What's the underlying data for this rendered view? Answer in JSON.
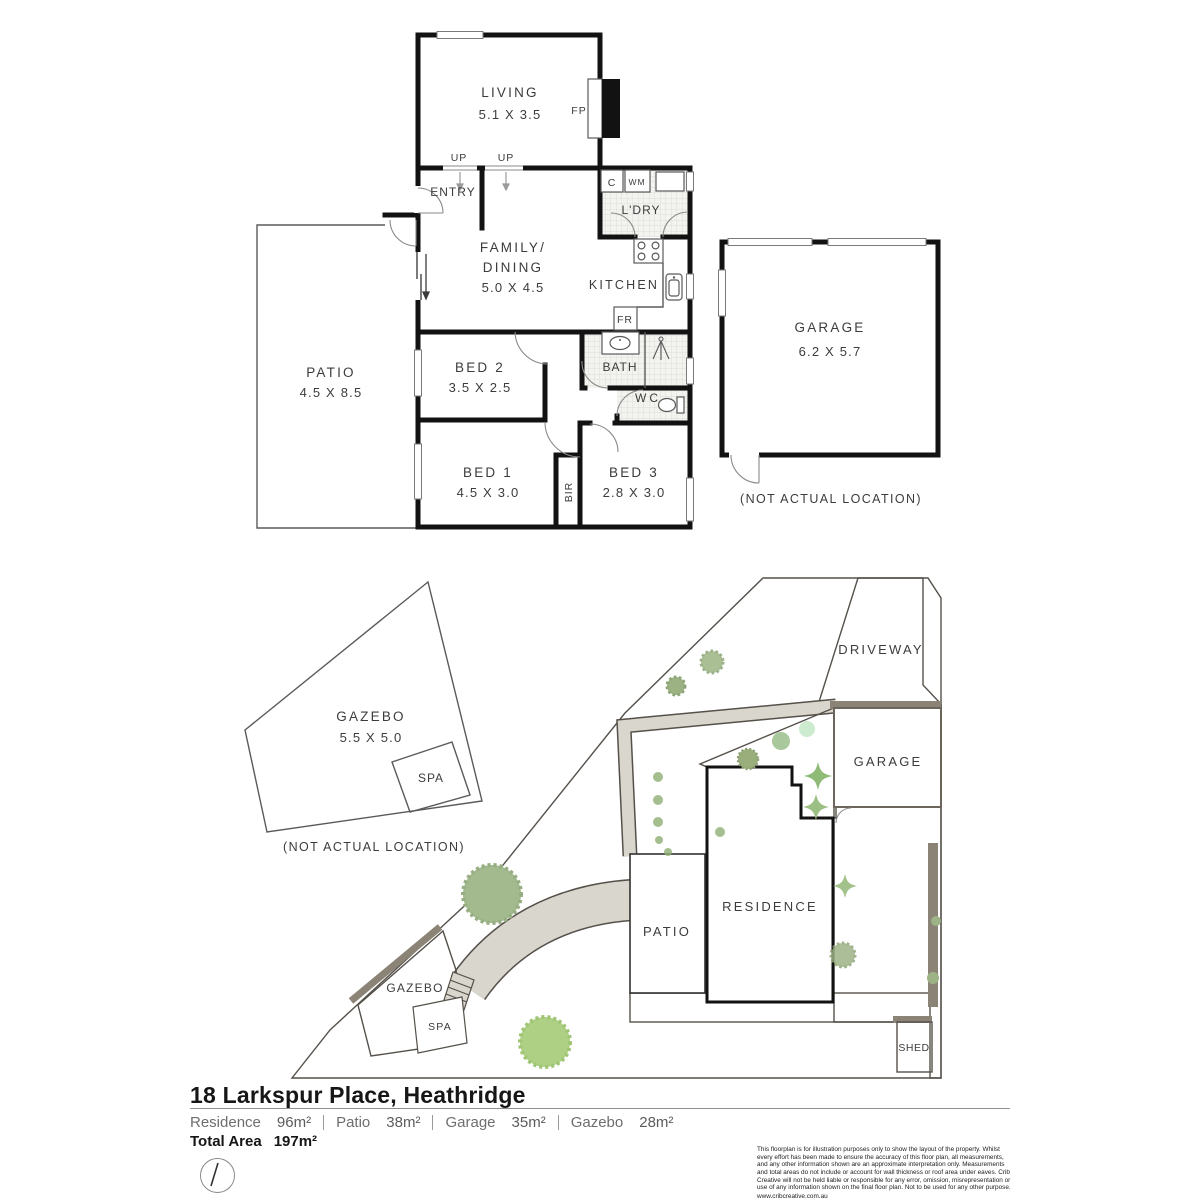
{
  "floor_plan": {
    "rooms": {
      "living": {
        "name": "LIVING",
        "dims": "5.1 X 3.5"
      },
      "entry": {
        "name": "ENTRY"
      },
      "family_dining": {
        "line1": "FAMILY/",
        "line2": "DINING",
        "dims": "5.0 X 4.5"
      },
      "kitchen": {
        "name": "KITCHEN"
      },
      "laundry": {
        "name": "L'DRY"
      },
      "patio": {
        "name": "PATIO",
        "dims": "4.5 X 8.5"
      },
      "bed1": {
        "name": "BED 1",
        "dims": "4.5 X 3.0"
      },
      "bed2": {
        "name": "BED 2",
        "dims": "3.5 X 2.5"
      },
      "bed3": {
        "name": "BED 3",
        "dims": "2.8 X 3.0"
      },
      "bath": {
        "name": "BATH"
      },
      "wc": {
        "name": "WC"
      },
      "bir": {
        "name": "BIR"
      },
      "garage": {
        "name": "GARAGE",
        "dims": "6.2 X 5.7",
        "note": "(NOT ACTUAL LOCATION)"
      },
      "gazebo": {
        "name": "GAZEBO",
        "dims": "5.5 X 5.0",
        "note": "(NOT ACTUAL LOCATION)"
      },
      "spa": {
        "name": "SPA"
      }
    },
    "markers": {
      "up1": "UP",
      "up2": "UP",
      "fp": "FP",
      "c": "C",
      "wm": "WM",
      "fr": "FR"
    }
  },
  "site_plan": {
    "labels": {
      "driveway": "DRIVEWAY",
      "garage": "GARAGE",
      "residence": "RESIDENCE",
      "patio": "PATIO",
      "gazebo": "GAZEBO",
      "spa": "SPA",
      "shed": "SHED"
    }
  },
  "footer": {
    "address": "18 Larkspur Place, Heathridge",
    "areas": [
      {
        "label": "Residence",
        "value": "96m²"
      },
      {
        "label": "Patio",
        "value": "38m²"
      },
      {
        "label": "Garage",
        "value": "35m²"
      },
      {
        "label": "Gazebo",
        "value": "28m²"
      }
    ],
    "total_label": "Total Area",
    "total_value": "197m²",
    "disclaimer": "This floorplan is for illustration purposes only to show the layout of the property. Whilst every effort has been made to ensure the accuracy of this floor plan, all measurements, and any other information shown are an approximate interpretation only. Measurements and total areas do not include or account for wall thickness or roof area under eaves. Crib Creative will not be held liable or responsible for any error, omission, misrepresentation or use of any information shown on the final floor plan. Not to be used for any other purpose.",
    "website": "www.cribcreative.com.au"
  },
  "colors": {
    "wall": "#121212",
    "lawn": "#e8eec2",
    "paving": "#d9d6ce",
    "courtyard": "#aca396",
    "shadow_band": "#8b8376",
    "tile_line": "#dcdcd8",
    "label_text": "#3c3c3c",
    "plant_green": "#a3ba8e"
  }
}
